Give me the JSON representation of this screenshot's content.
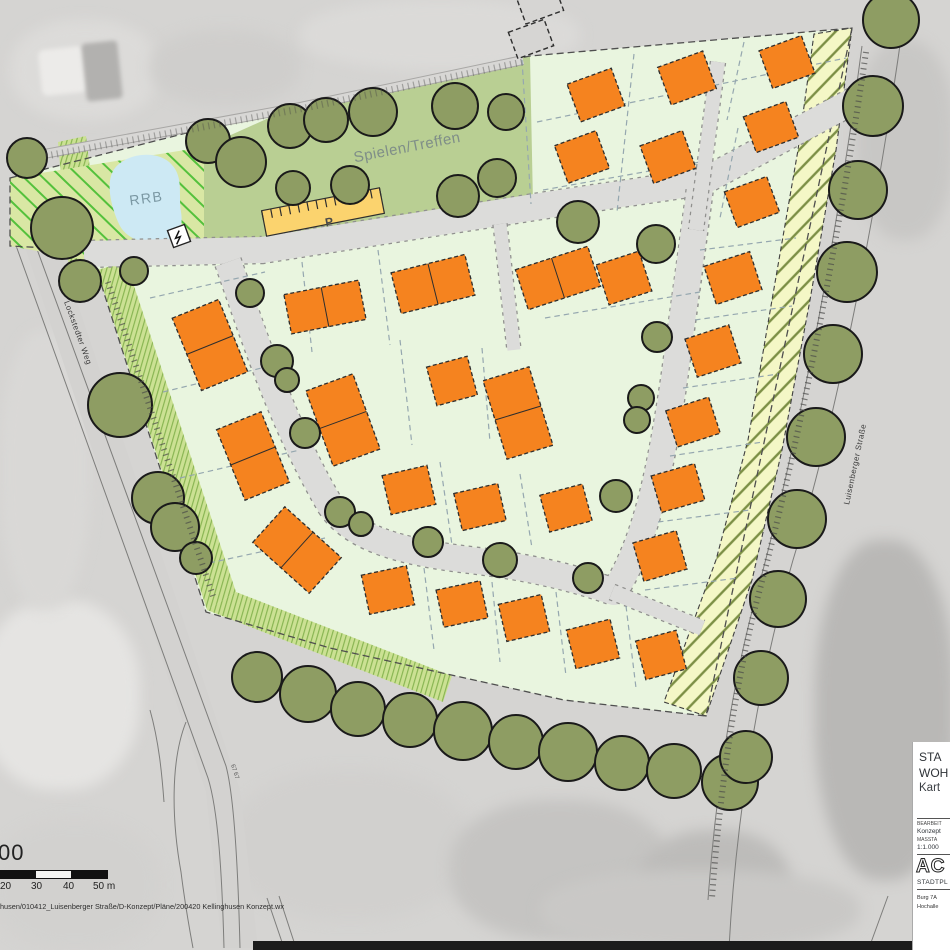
{
  "labels": {
    "rrb": "RRB",
    "play_area": "Spielen/Treffen",
    "parking": "P",
    "street_left": "Lockstedter Weg",
    "street_right": "Luisenberger Straße",
    "parcel_number": "67 67"
  },
  "scale_bar": {
    "partial_ratio_text": "00",
    "tick_labels": [
      "20",
      "30",
      "40",
      "50 m"
    ]
  },
  "footer": {
    "file_path": "husen/010412_Luisenberger Straße/D-Konzept/Pläne/200420 Kellinghusen Konzept.wx"
  },
  "title_block": {
    "title_line1": "STA",
    "title_line2": "WOH",
    "title_line3": "Kart",
    "field1_label": "BEARBEIT",
    "field1_value": "Konzept",
    "field2_label": "MASSTA",
    "field2_value": "1:1.000",
    "logo_text": "AC",
    "firm_line": "STADTPL",
    "address_line1": "Burg 7A",
    "address_line2": "Hochalle"
  },
  "colors": {
    "orange": "#f5831f",
    "tree": "#8e9d63",
    "treeStroke": "#1a1a1a",
    "road": "#dcdcda",
    "roadEdge": "#90908e",
    "parcel": "#e9f5df",
    "park": "#b9cf93",
    "rrbFill": "#d9e7a4",
    "rrbLine": "#54c13c",
    "pond": "#cde9f4",
    "hatchFill": "#f4f7c6",
    "hatchLine": "#7c8f45",
    "leftFill": "#cbe193",
    "leftLine": "#84b24e",
    "parking": "#fbd36e",
    "parcelLine": "#95a7af",
    "outline": "#4f4f4f",
    "aerialRoad": "#d3d2d0"
  },
  "map": {
    "site_outline": [
      [
        10,
        178
      ],
      [
        300,
        104
      ],
      [
        530,
        56
      ],
      [
        852,
        28
      ],
      [
        706,
        716
      ],
      [
        564,
        700
      ],
      [
        330,
        648
      ],
      [
        206,
        612
      ],
      [
        96,
        268
      ],
      [
        88,
        250
      ],
      [
        10,
        246
      ]
    ],
    "rrb_area": [
      [
        10,
        178
      ],
      [
        204,
        147
      ],
      [
        204,
        244
      ],
      [
        98,
        262
      ],
      [
        10,
        246
      ]
    ],
    "park_area": [
      [
        204,
        147
      ],
      [
        300,
        104
      ],
      [
        530,
        56
      ],
      [
        533,
        204
      ],
      [
        420,
        222
      ],
      [
        262,
        240
      ],
      [
        204,
        244
      ]
    ],
    "yellow_wedge": [
      [
        58,
        142
      ],
      [
        86,
        136
      ],
      [
        101,
        260
      ],
      [
        69,
        270
      ]
    ],
    "left_strip": [
      [
        [
          97,
          270
        ],
        [
          126,
          262
        ],
        [
          236,
          592
        ],
        [
          207,
          610
        ]
      ],
      [
        [
          207,
          610
        ],
        [
          236,
          592
        ],
        [
          452,
          676
        ],
        [
          443,
          702
        ]
      ]
    ],
    "hatch_strip": [
      [
        852,
        28
      ],
      [
        836,
        150
      ],
      [
        810,
        300
      ],
      [
        782,
        450
      ],
      [
        752,
        580
      ],
      [
        706,
        716
      ],
      [
        664,
        702
      ],
      [
        716,
        560
      ],
      [
        748,
        440
      ],
      [
        772,
        300
      ],
      [
        798,
        150
      ],
      [
        814,
        34
      ]
    ],
    "pond_path": "M115,168 C128,152 160,150 172,165 C184,178 178,196 181,212 C184,230 176,240 162,242 C146,245 128,240 120,226 C112,210 104,182 115,168 Z",
    "top_path": "M44,154 L300,107 L523,60",
    "left_road_band": [
      [
        20,
        232
      ],
      [
        52,
        227
      ],
      [
        240,
        790
      ],
      [
        258,
        948
      ],
      [
        222,
        948
      ],
      [
        206,
        792
      ]
    ],
    "roads": [
      {
        "name": "road-main-access",
        "d": "M84,254 L262,250 L560,203 L702,182 L870,92",
        "w": 26
      },
      {
        "name": "road-residential-loop",
        "d": "M228,262 C252,330 280,420 330,505 C352,538 400,552 470,560 C530,567 575,578 614,592 C648,540 662,460 674,380 C683,315 692,250 700,188",
        "w": 26
      },
      {
        "name": "footpath-north",
        "d": "M718,62 L696,230",
        "w": 14
      },
      {
        "name": "footpath-center",
        "d": "M500,224 L514,350",
        "w": 13
      },
      {
        "name": "footpath-east",
        "d": "M612,592 L702,628",
        "w": 15
      }
    ],
    "parking_lot": {
      "cx": 323,
      "cy": 212,
      "w": 120,
      "h": 26,
      "rot": -11
    },
    "transformer": {
      "x": 170,
      "y": 227,
      "s": 18,
      "rot": -20
    },
    "houses": [
      [
        596,
        95,
        47,
        40,
        -20,
        "s"
      ],
      [
        687,
        78,
        48,
        40,
        -20,
        "s"
      ],
      [
        787,
        62,
        45,
        40,
        -20,
        "s"
      ],
      [
        582,
        157,
        44,
        40,
        -20,
        "s"
      ],
      [
        668,
        157,
        45,
        40,
        -20,
        "s"
      ],
      [
        771,
        127,
        45,
        38,
        -20,
        "s"
      ],
      [
        752,
        202,
        45,
        38,
        -20,
        "s"
      ],
      [
        733,
        278,
        48,
        40,
        -18,
        "s"
      ],
      [
        713,
        351,
        46,
        40,
        -18,
        "s"
      ],
      [
        693,
        422,
        45,
        38,
        -18,
        "s"
      ],
      [
        678,
        488,
        45,
        38,
        -16,
        "s"
      ],
      [
        660,
        556,
        45,
        40,
        -16,
        "s"
      ],
      [
        325,
        307,
        76,
        40,
        -11,
        "dh"
      ],
      [
        433,
        284,
        76,
        42,
        -14,
        "dh"
      ],
      [
        558,
        278,
        76,
        42,
        -18,
        "dh"
      ],
      [
        624,
        278,
        45,
        42,
        -18,
        "s"
      ],
      [
        452,
        381,
        42,
        40,
        -15,
        "s"
      ],
      [
        518,
        413,
        48,
        82,
        -17,
        "dv"
      ],
      [
        343,
        420,
        50,
        80,
        -20,
        "dv"
      ],
      [
        210,
        345,
        50,
        78,
        -22,
        "dv"
      ],
      [
        253,
        456,
        48,
        76,
        -22,
        "dv"
      ],
      [
        297,
        550,
        48,
        76,
        -48,
        "dv"
      ],
      [
        409,
        490,
        46,
        40,
        -13,
        "s"
      ],
      [
        480,
        507,
        45,
        38,
        -13,
        "s"
      ],
      [
        566,
        508,
        44,
        38,
        -15,
        "s"
      ],
      [
        388,
        590,
        46,
        40,
        -12,
        "s"
      ],
      [
        462,
        604,
        45,
        38,
        -12,
        "s"
      ],
      [
        524,
        618,
        44,
        38,
        -13,
        "s"
      ],
      [
        593,
        644,
        45,
        40,
        -14,
        "s"
      ],
      [
        661,
        655,
        42,
        40,
        -15,
        "s"
      ]
    ],
    "trees": [
      [
        27,
        158,
        20
      ],
      [
        62,
        228,
        31
      ],
      [
        80,
        281,
        21
      ],
      [
        134,
        271,
        14
      ],
      [
        208,
        141,
        22
      ],
      [
        241,
        162,
        25
      ],
      [
        290,
        126,
        22
      ],
      [
        326,
        120,
        22
      ],
      [
        373,
        112,
        24
      ],
      [
        455,
        106,
        23
      ],
      [
        506,
        112,
        18
      ],
      [
        293,
        188,
        17
      ],
      [
        350,
        185,
        19
      ],
      [
        458,
        196,
        21
      ],
      [
        497,
        178,
        19
      ],
      [
        578,
        222,
        21
      ],
      [
        656,
        244,
        19
      ],
      [
        120,
        405,
        32
      ],
      [
        158,
        498,
        26
      ],
      [
        175,
        527,
        24
      ],
      [
        196,
        558,
        16
      ],
      [
        250,
        293,
        14
      ],
      [
        277,
        361,
        16
      ],
      [
        287,
        380,
        12
      ],
      [
        305,
        433,
        15
      ],
      [
        340,
        512,
        15
      ],
      [
        361,
        524,
        12
      ],
      [
        428,
        542,
        15
      ],
      [
        500,
        560,
        17
      ],
      [
        588,
        578,
        15
      ],
      [
        616,
        496,
        16
      ],
      [
        657,
        337,
        15
      ],
      [
        641,
        398,
        13
      ],
      [
        637,
        420,
        13
      ],
      [
        257,
        677,
        25
      ],
      [
        308,
        694,
        28
      ],
      [
        358,
        709,
        27
      ],
      [
        410,
        720,
        27
      ],
      [
        463,
        731,
        29
      ],
      [
        516,
        742,
        27
      ],
      [
        568,
        752,
        29
      ],
      [
        622,
        763,
        27
      ],
      [
        674,
        771,
        27
      ],
      [
        730,
        782,
        28
      ],
      [
        891,
        20,
        28
      ],
      [
        873,
        106,
        30
      ],
      [
        858,
        190,
        29
      ],
      [
        847,
        272,
        30
      ],
      [
        833,
        354,
        29
      ],
      [
        816,
        437,
        29
      ],
      [
        797,
        519,
        29
      ],
      [
        778,
        599,
        28
      ],
      [
        761,
        678,
        27
      ],
      [
        746,
        757,
        26
      ]
    ],
    "parcel_lines": [
      [
        522,
        60,
        531,
        204
      ],
      [
        537,
        122,
        846,
        58
      ],
      [
        634,
        54,
        617,
        212
      ],
      [
        744,
        42,
        727,
        120
      ],
      [
        738,
        128,
        720,
        218
      ],
      [
        543,
        190,
        700,
        162
      ],
      [
        700,
        250,
        796,
        238
      ],
      [
        695,
        320,
        792,
        306
      ],
      [
        683,
        388,
        778,
        374
      ],
      [
        670,
        456,
        763,
        442
      ],
      [
        658,
        522,
        750,
        510
      ],
      [
        645,
        590,
        738,
        578
      ],
      [
        150,
        298,
        265,
        272
      ],
      [
        163,
        392,
        278,
        364
      ],
      [
        180,
        478,
        300,
        450
      ],
      [
        200,
        565,
        325,
        538
      ],
      [
        378,
        250,
        390,
        345
      ],
      [
        302,
        262,
        312,
        352
      ],
      [
        545,
        318,
        700,
        292
      ],
      [
        400,
        340,
        412,
        445
      ],
      [
        482,
        348,
        490,
        442
      ],
      [
        440,
        462,
        452,
        545
      ],
      [
        520,
        474,
        532,
        548
      ],
      [
        424,
        568,
        434,
        650
      ],
      [
        492,
        582,
        500,
        662
      ],
      [
        556,
        592,
        566,
        676
      ],
      [
        626,
        606,
        636,
        688
      ]
    ],
    "existing_buildings": [
      [
        540,
        4,
        40,
        28,
        -20
      ],
      [
        531,
        39,
        38,
        28,
        -20
      ]
    ],
    "base_lines": [
      "M30,230 L226,766 C234,796 238,866 240,948",
      "M14,240 L208,778 C218,810 222,872 224,948",
      "M906,2 C882,180 842,400 793,560 C762,668 737,800 729,948",
      "M862,46 C840,215 803,425 755,600 C733,682 716,788 708,900",
      "M186,722 C170,762 172,822 181,872 C185,904 190,932 193,948",
      "M150,710 C159,742 162,775 164,802",
      "M267,898 L284,948",
      "M279,896 L296,948",
      "M888,896 L869,948"
    ],
    "tick_lines": [
      {
        "d": "M108,282 L213,596",
        "w": 6,
        "o": 0.7
      },
      {
        "d": "M866,52 C842,216 804,426 757,600 C735,686 720,788 712,898",
        "w": 6,
        "o": 0.7
      },
      {
        "d": "M46,156 L300,109 L523,62",
        "w": 7,
        "o": 0.4
      }
    ],
    "map_labels": [
      {
        "key": "rrb",
        "x": 147,
        "y": 203,
        "rot": -8,
        "size": 14,
        "color": "#7b98a3",
        "ls": 1.5,
        "anchor": "middle",
        "bold": false
      },
      {
        "key": "play_area",
        "x": 408,
        "y": 152,
        "rot": -11,
        "size": 15,
        "color": "#7f8e88",
        "ls": 0.5,
        "anchor": "middle",
        "bold": false
      },
      {
        "key": "parking",
        "x": 330,
        "y": 226,
        "rot": -11,
        "size": 12,
        "color": "#4a4a4a",
        "ls": 0,
        "anchor": "middle",
        "bold": true
      },
      {
        "key": "street_left",
        "x": 64,
        "y": 302,
        "rot": 70,
        "size": 8,
        "color": "#3a3a3a",
        "ls": 0.5,
        "anchor": "start",
        "bold": false
      },
      {
        "key": "street_right",
        "x": 849,
        "y": 505,
        "rot": -78,
        "size": 8,
        "color": "#3a3a3a",
        "ls": 0.5,
        "anchor": "start",
        "bold": false
      },
      {
        "key": "parcel_number",
        "x": 231,
        "y": 765,
        "rot": 72,
        "size": 6,
        "color": "#555555",
        "ls": 0,
        "anchor": "start",
        "bold": false
      }
    ]
  }
}
